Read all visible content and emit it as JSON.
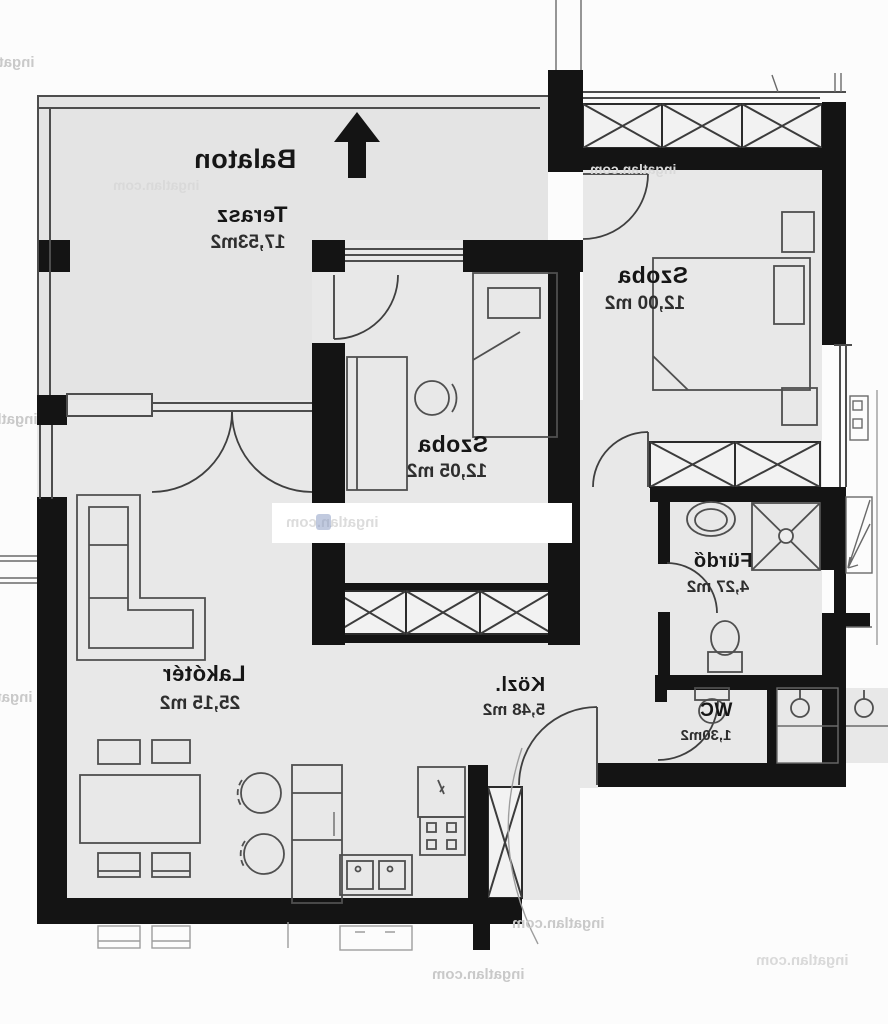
{
  "plan": {
    "compass_label": "Balaton",
    "rooms": [
      {
        "name": "Terasz",
        "area": "17,53m2"
      },
      {
        "name": "Szoba",
        "area": "12,00 m2"
      },
      {
        "name": "Szoba",
        "area": "12,05 m2"
      },
      {
        "name": "Lakótér",
        "area": "25,15 m2"
      },
      {
        "name": "Közl.",
        "area": "5,48 m2"
      },
      {
        "name": "Fürdő",
        "area": "4,27 m2"
      },
      {
        "name": "WC",
        "area": "1,30m2"
      }
    ]
  },
  "watermark": {
    "text": "ingatlan.com"
  },
  "colors": {
    "wall": "#141414",
    "line": "#4d4d4d",
    "floor": "#e8e8e8",
    "terrace": "#e4e4e4",
    "hatch_fill": "#f2f2f2",
    "paper": "#fcfcfc",
    "watermark_gray": "#c9c9c9",
    "logo_blue": "#8e9fc4"
  }
}
